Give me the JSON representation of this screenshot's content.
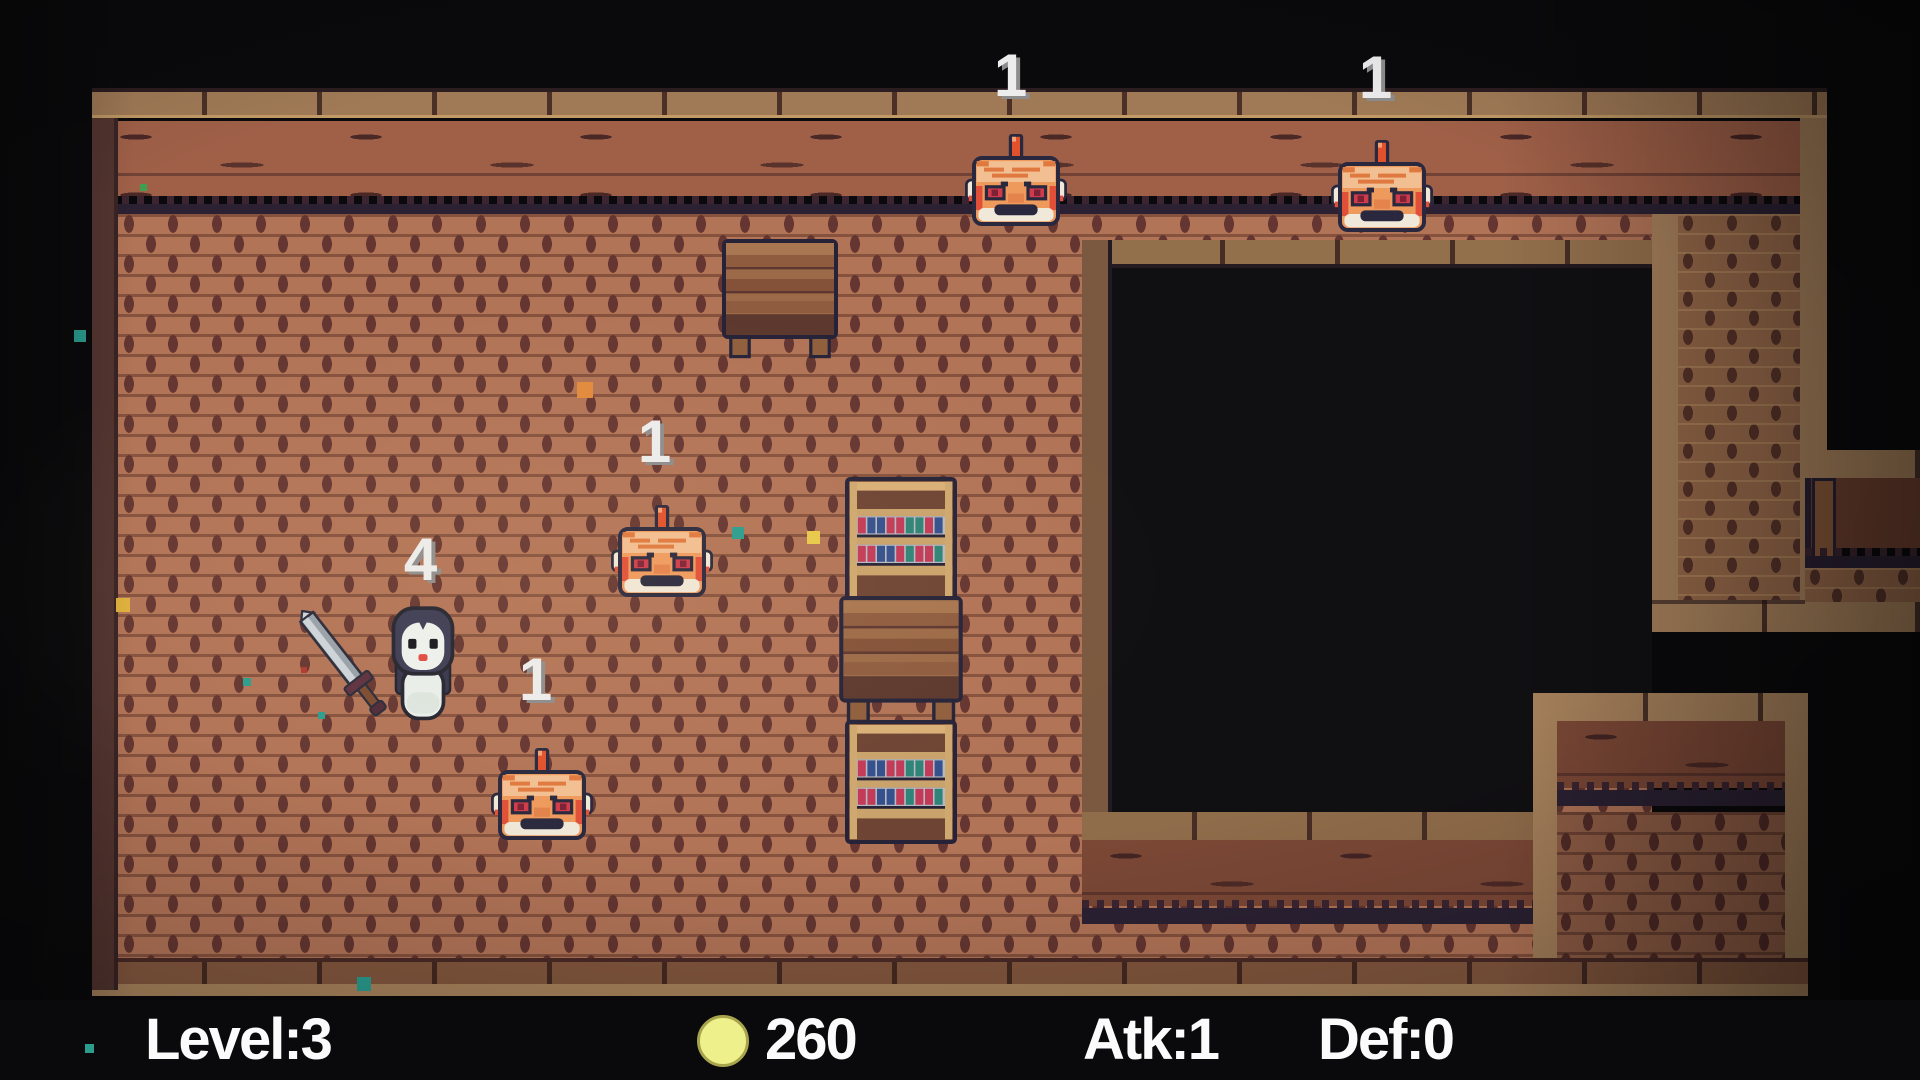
{
  "hud": {
    "level": "Level:3",
    "gold": "260",
    "atk": "Atk:1",
    "def": "Def:0",
    "coin_color": "#eef08c"
  },
  "entities": {
    "player": {
      "type": "penguin-hero-with-sword",
      "hp": "4"
    },
    "enemies": [
      {
        "type": "spike-crab",
        "hp": "1",
        "position": "top-left"
      },
      {
        "type": "spike-crab",
        "hp": "1",
        "position": "top-right"
      },
      {
        "type": "spike-crab",
        "hp": "1",
        "position": "middle"
      },
      {
        "type": "spike-crab",
        "hp": "1",
        "position": "lower-left"
      }
    ]
  },
  "furniture": [
    {
      "type": "wooden-table"
    },
    {
      "type": "bookshelf"
    },
    {
      "type": "wooden-crate-table"
    },
    {
      "type": "bookshelf"
    }
  ],
  "palette": {
    "void": "#0a0a0c",
    "floor_brick": "#b27457",
    "floor_joint": "#653631",
    "wall_plank": "#a06048",
    "wall_tan": "#a8825c",
    "pit": "#100f12",
    "outline_navy": "#29283e"
  },
  "effects": {
    "particles": [
      {
        "x": 74,
        "y": 330,
        "s": 12,
        "c": "#2a9d8f"
      },
      {
        "x": 140,
        "y": 184,
        "s": 7,
        "c": "#3f9e4f"
      },
      {
        "x": 116,
        "y": 598,
        "s": 14,
        "c": "#e0b23c"
      },
      {
        "x": 577,
        "y": 382,
        "s": 16,
        "c": "#e08a3c"
      },
      {
        "x": 807,
        "y": 531,
        "s": 13,
        "c": "#e8c84a"
      },
      {
        "x": 732,
        "y": 527,
        "s": 12,
        "c": "#2a9d8f"
      },
      {
        "x": 243,
        "y": 678,
        "s": 8,
        "c": "#2a9d8f"
      },
      {
        "x": 318,
        "y": 712,
        "s": 7,
        "c": "#2a9d8f"
      },
      {
        "x": 301,
        "y": 667,
        "s": 6,
        "c": "#b03830"
      },
      {
        "x": 357,
        "y": 977,
        "s": 14,
        "c": "#2a9d8f"
      },
      {
        "x": 85,
        "y": 1044,
        "s": 9,
        "c": "#2a9d8f"
      }
    ]
  }
}
